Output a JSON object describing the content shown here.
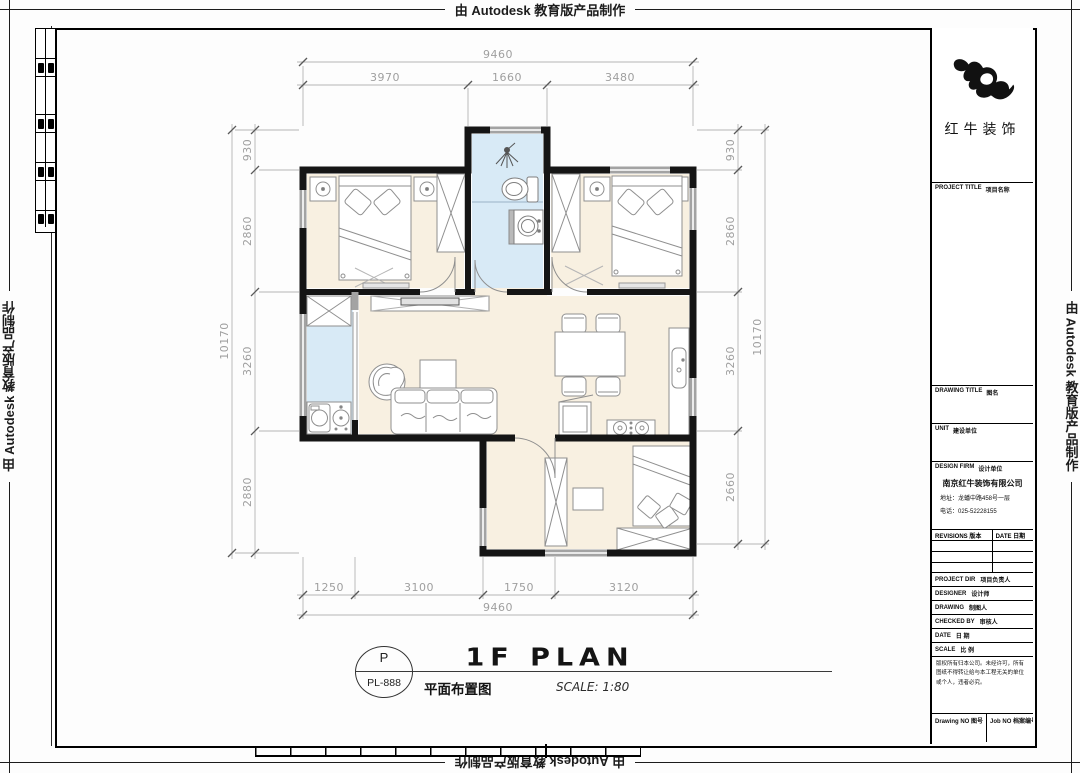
{
  "watermark": "由 Autodesk 教育版产品制作",
  "logo": {
    "name": "红牛装饰"
  },
  "plan": {
    "title": "1F PLAN",
    "subtitle": "平面布置图",
    "scale": "SCALE: 1:80",
    "sheet_ref": "P",
    "sheet_no": "PL-888",
    "dims": {
      "top_total": "9460",
      "top": [
        "3970",
        "1660",
        "3480"
      ],
      "left_total": "10170",
      "left": [
        "930",
        "2860",
        "3260",
        "2880"
      ],
      "right_total": "10170",
      "right": [
        "930",
        "2860",
        "3260",
        "2660"
      ],
      "bottom_total": "9460",
      "bottom": [
        "1250",
        "3100",
        "1750",
        "3120"
      ]
    }
  },
  "titleblock": {
    "fields": [
      {
        "en": "PROJECT TITLE",
        "cn": "项目名称"
      },
      {
        "en": "DRAWING TITLE",
        "cn": "图名"
      },
      {
        "en": "UNIT",
        "cn": "建设单位"
      },
      {
        "en": "DESIGN FIRM",
        "cn": "设计单位"
      },
      {
        "en": "PROJECT DIR",
        "cn": "项目负责人"
      },
      {
        "en": "DESIGNER",
        "cn": "设计师"
      },
      {
        "en": "DRAWING",
        "cn": "制图人"
      },
      {
        "en": "CHECKED BY",
        "cn": "审核人"
      },
      {
        "en": "DATE",
        "cn": "日  期"
      },
      {
        "en": "SCALE",
        "cn": "比  例"
      }
    ],
    "revisions": {
      "en": "REVISIONS",
      "cn": "版本",
      "date_en": "DATE",
      "date_cn": "日期"
    },
    "company": {
      "name": "南京红牛装饰有限公司",
      "address": "地址：龙蟠中路458号一层",
      "phone": "电话：025-52228155"
    },
    "notes": "版权所有归本公司。未经许可，所有图纸不得转让给与本工程无关的单位或个人，违者必究。",
    "drawing_no": {
      "en": "Drawing NO",
      "cn": "图号"
    },
    "job_no": {
      "en": "Job NO",
      "cn": "档案编号"
    }
  },
  "colors": {
    "wall": "#151515",
    "window_gray": "#a3a3a3",
    "floor_beige": "#f8f0e1",
    "floor_blue": "#d8eaf6",
    "dim_gray": "#9f9f9f"
  }
}
